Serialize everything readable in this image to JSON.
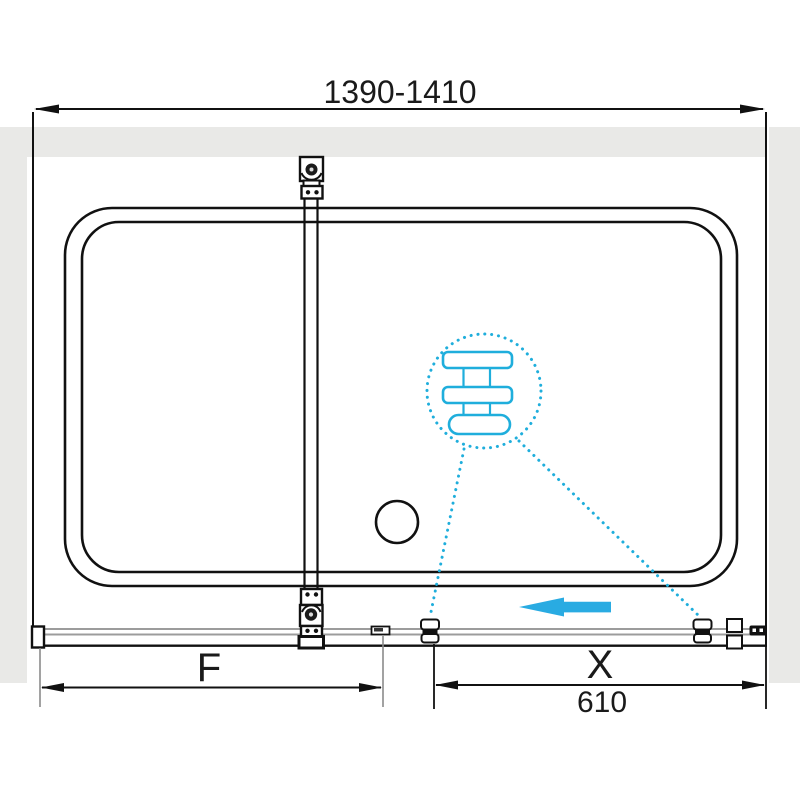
{
  "diagram": {
    "dimensions": {
      "overall": {
        "label": "1390-1410"
      },
      "fixed_panel": {
        "label": "F"
      },
      "sliding_panel": {
        "label": "X",
        "value": "610"
      }
    },
    "colors": {
      "accent": "#29ABE2",
      "detail": "#1FAEDC",
      "line": "#111111",
      "wall": "#E9E9E7",
      "track": "#9C9C9C"
    },
    "icons": {
      "roller": "roller-wheel-icon",
      "towel_bar": "towel-bar-icon",
      "slide_arrow": "slide-direction-arrow-icon"
    }
  }
}
